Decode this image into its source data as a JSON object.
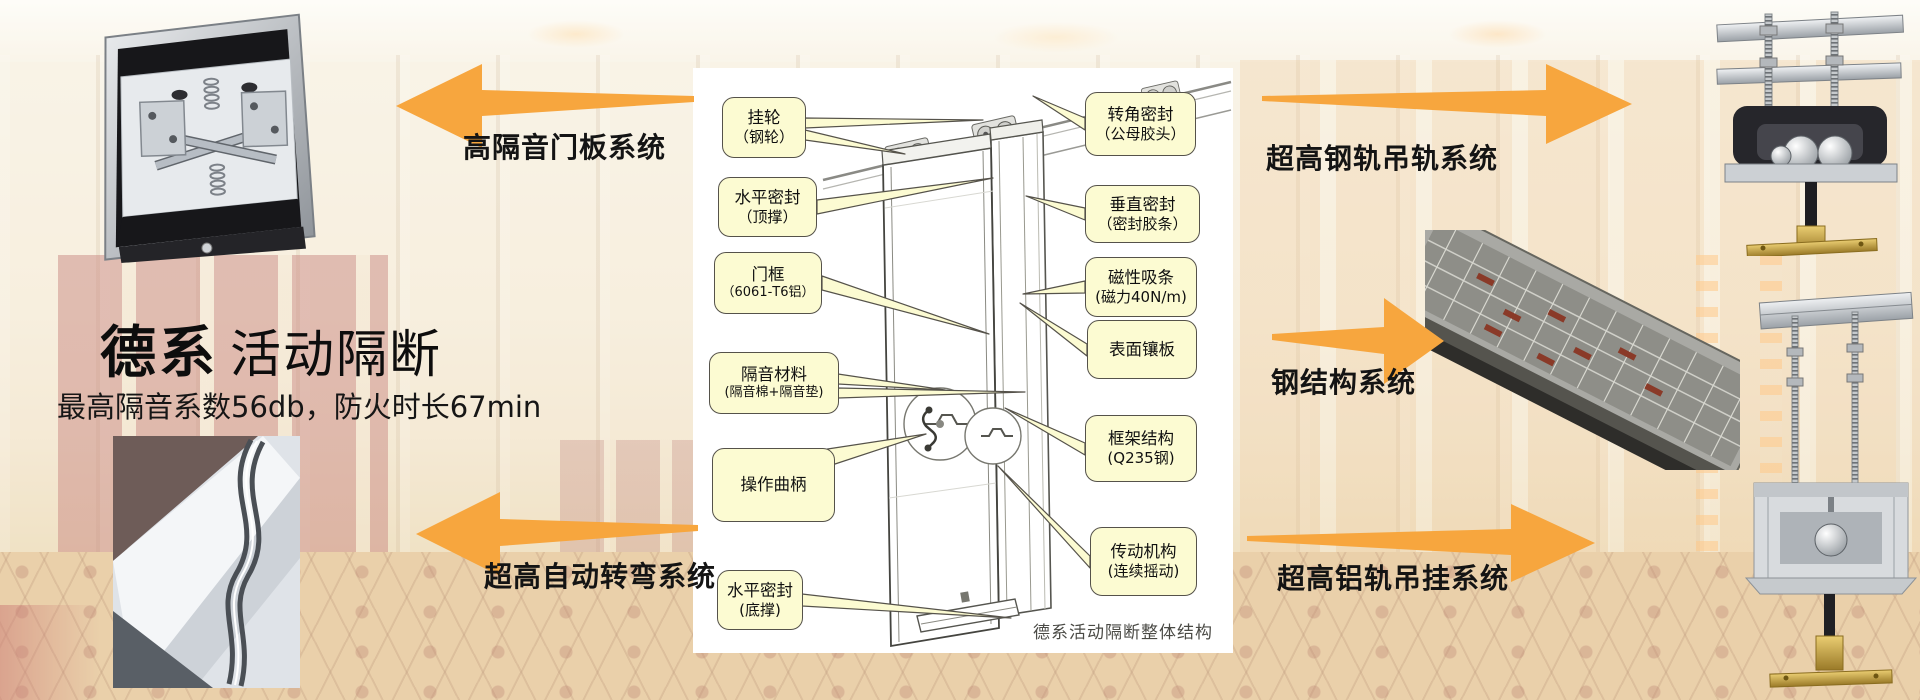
{
  "hero": {
    "title_primary": "德系",
    "title_secondary": "活动隔断",
    "subtitle": "最高隔音系数56db，防火时长67min"
  },
  "system_labels": {
    "door_panel": "高隔音门板系统",
    "auto_turn": "超高自动转弯系统",
    "steel_rail": "超高钢轨吊轨系统",
    "steel_structure": "钢结构系统",
    "alu_rail": "超高铝轨吊挂系统"
  },
  "diagram": {
    "caption": "德系活动隔断整体结构",
    "callouts_left": [
      {
        "line1": "挂轮",
        "line2": "（钢轮）"
      },
      {
        "line1": "水平密封",
        "line2": "（顶撑）"
      },
      {
        "line1": "门框",
        "line2": "（6061-T6铝）"
      },
      {
        "line1": "隔音材料",
        "line2": "(隔音棉+隔音垫)"
      },
      {
        "line1": "操作曲柄",
        "line2": ""
      },
      {
        "line1": "水平密封",
        "line2": "(底撑)"
      }
    ],
    "callouts_right": [
      {
        "line1": "转角密封",
        "line2": "（公母胶头）"
      },
      {
        "line1": "垂直密封",
        "line2": "（密封胶条）"
      },
      {
        "line1": "磁性吸条",
        "line2": "(磁力40N/m)"
      },
      {
        "line1": "表面镶板",
        "line2": ""
      },
      {
        "line1": "框架结构",
        "line2": "(Q235钢)"
      },
      {
        "line1": "传动机构",
        "line2": "(连续摇动)"
      }
    ]
  },
  "photos": {
    "door_mechanism": "door-panel-top-mechanism-photo",
    "curved_track": "curved-track-system-photo",
    "steel_frame": "steel-structure-frame-photo",
    "steel_hanger": "steel-rail-hanger-photo",
    "alu_hanger": "aluminium-rail-hanger-photo"
  },
  "colors": {
    "arrow_orange": "#F7A63E",
    "callout_fill": "#FCFBD2",
    "callout_border": "#55524A"
  }
}
